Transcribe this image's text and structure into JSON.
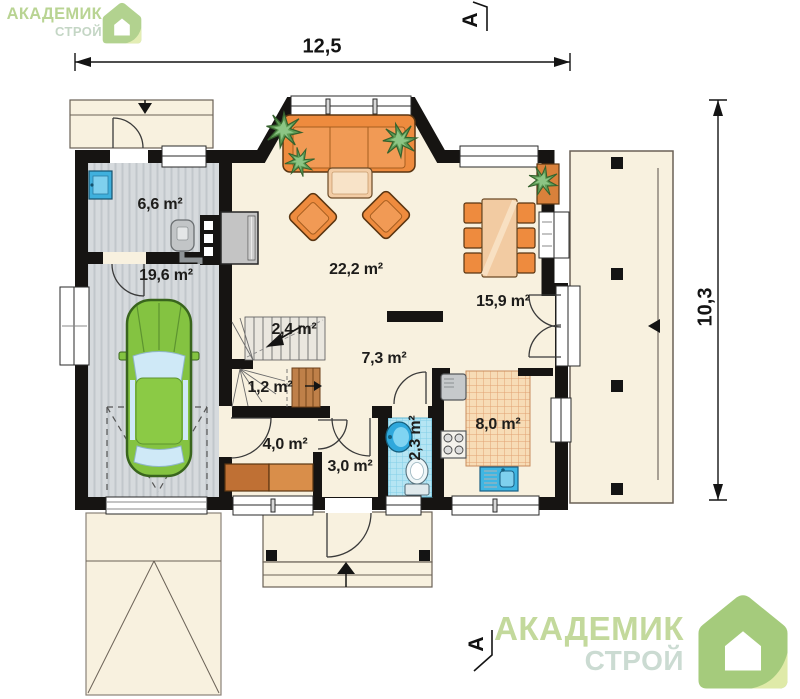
{
  "branding": {
    "logo_top": {
      "line1": "АКАДЕМИК",
      "line2": "СТРОЙ"
    },
    "logo_bottom": {
      "line1": "АКАДЕМИК",
      "line2": "СТРОЙ"
    }
  },
  "dimensions": {
    "width_label": "12,5",
    "height_label": "10,3"
  },
  "section_markers": {
    "top": "А",
    "bottom": "А"
  },
  "rooms": [
    {
      "id": "utility",
      "label": "6,6 m²"
    },
    {
      "id": "garage",
      "label": "19,6 m²"
    },
    {
      "id": "living-room",
      "label": "22,2 m²"
    },
    {
      "id": "dining-room",
      "label": "15,9 m²"
    },
    {
      "id": "stairs-upper",
      "label": "2,4 m²"
    },
    {
      "id": "stairs-lower",
      "label": "1,2 m²"
    },
    {
      "id": "hall",
      "label": "7,3 m²"
    },
    {
      "id": "wardrobe",
      "label": "4,0 m²"
    },
    {
      "id": "vestibule",
      "label": "3,0 m²"
    },
    {
      "id": "bathroom",
      "label": "2,3 m²"
    },
    {
      "id": "kitchen",
      "label": "8,0 m²"
    }
  ],
  "colors": {
    "wall": "#161412",
    "floor_cream": "#f8f1df",
    "garage_floor": "#d6dadd",
    "kitchen_tile": "#f7dcb6",
    "bath_tile": "#b5e5f3",
    "furniture_orange": "#ee8b3e",
    "car_green": "#84c341",
    "plant_green": "#5f9c55",
    "sink_blue": "#3fb0dd",
    "logo_green": "#c3d99c",
    "logo_teal": "#cbdbd2"
  }
}
